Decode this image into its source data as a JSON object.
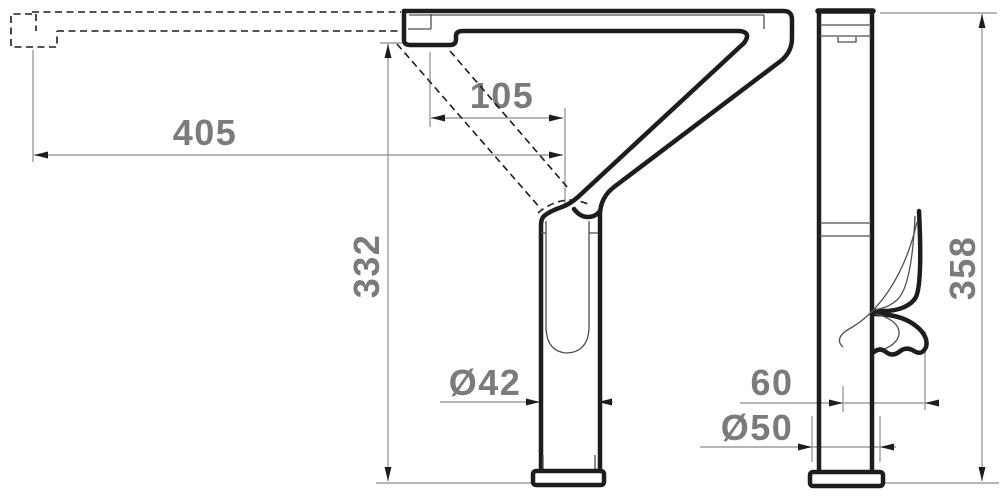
{
  "page": {
    "background": "#ffffff"
  },
  "drawing": {
    "type": "technical-dimension-drawing",
    "subject": "kitchen-faucet",
    "views": {
      "side": "side elevation with swivel spout alternate position shown dashed",
      "front": "front elevation with lever handle"
    },
    "colors": {
      "outline": "#1d1d1b",
      "detail": "#4f4f4f",
      "dimension_line": "#9d9d9c",
      "dimension_text": "#7b7b7b",
      "background": "#ffffff"
    },
    "dimensions": {
      "reach": {
        "label": "405"
      },
      "spout_offset": {
        "label": "105"
      },
      "spout_height": {
        "label": "332"
      },
      "column_diameter": {
        "label": "Ø42"
      },
      "total_height": {
        "label": "358"
      },
      "handle_offset": {
        "label": "60"
      },
      "base_diameter": {
        "label": "Ø50"
      }
    }
  }
}
